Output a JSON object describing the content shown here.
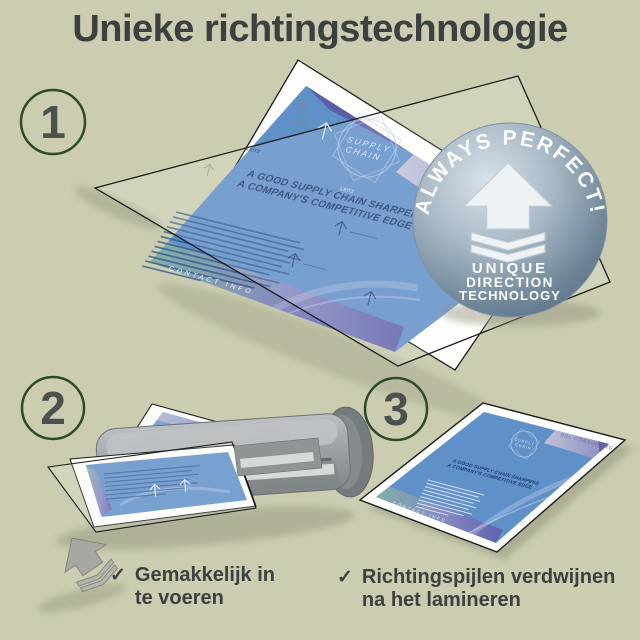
{
  "page": {
    "title": "Unieke richtingstechnologie"
  },
  "steps": [
    "1",
    "2",
    "3"
  ],
  "badge": {
    "arc_text": "ALWAYS PERFECT!",
    "label_lines": [
      "UNIQUE",
      "DIRECTION",
      "TECHNOLOGY"
    ]
  },
  "brochure": {
    "brand": "BBL CONSULTING",
    "logo_lines": [
      "SUPPLY",
      "CHAIN"
    ],
    "heading_lines": [
      "A GOOD SUPPLY CHAIN SHARPENS",
      "A COMPANY'S COMPETITIVE EDGE"
    ],
    "footer": "CONTACT INFO"
  },
  "pouch": {
    "watermark": "LEITZ"
  },
  "captions": [
    {
      "check": "✓",
      "lines": [
        "Gemakkelijk in",
        "te voeren"
      ]
    },
    {
      "check": "✓",
      "lines": [
        "Richtingspijlen verdwijnen",
        "na het lamineren"
      ]
    }
  ],
  "colors": {
    "background": "#cbccb0",
    "title_text": "#3a4140",
    "step_circle": "#2c4a2c",
    "step_number": "#4b5150",
    "document_blue": "#6090c8",
    "heading_navy": "#1c3c6d",
    "badge_base": "#93a7b6",
    "laminator_gray": "#9aa0a3",
    "accent_teal": "#86b3a3",
    "accent_purple": "#5f5aa5"
  }
}
